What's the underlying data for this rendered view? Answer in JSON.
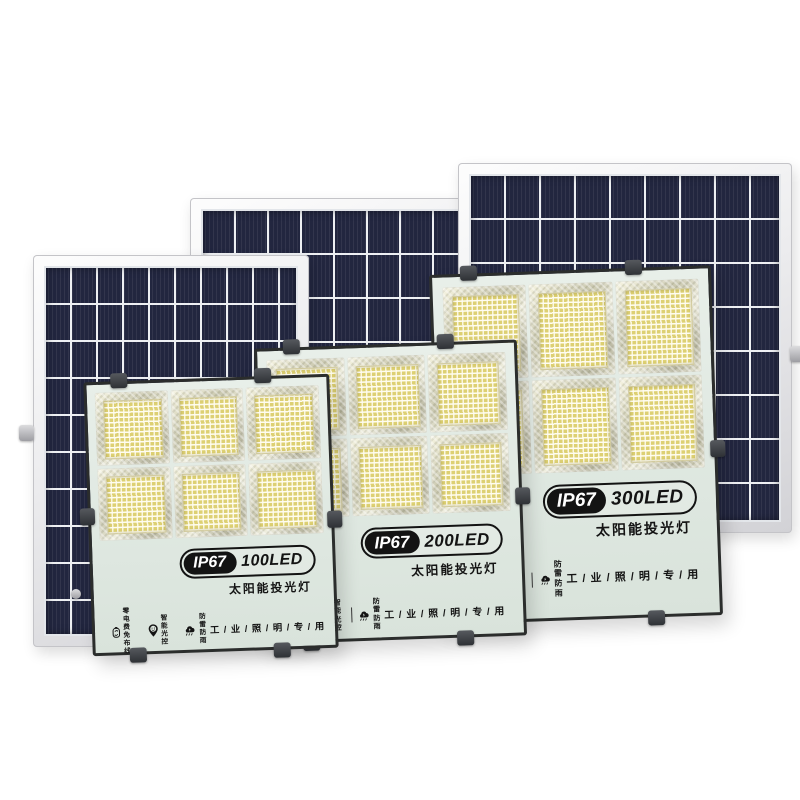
{
  "image_type": "product-photo",
  "subject": "solar-led-floodlights-with-solar-panels",
  "colors": {
    "background": "#ffffff",
    "solar_cell_navy": "#22263f",
    "panel_frame_silver": "#ececee",
    "light_face_mint": "#e1eae2",
    "light_frame_dark": "#2b2d2c",
    "badge_black": "#131313",
    "led_yellow": "#ddd073"
  },
  "panels": [
    {
      "name": "solar-panel-small-left"
    },
    {
      "name": "solar-panel-medium-back"
    },
    {
      "name": "solar-panel-large-right"
    }
  ],
  "lights": [
    {
      "ip_rating": "IP67",
      "led_count": "100LED",
      "subtitle": "太阳能投光灯",
      "usage": "工 / 业 / 照 / 明 / 专 / 用"
    },
    {
      "ip_rating": "IP67",
      "led_count": "200LED",
      "subtitle": "太阳能投光灯",
      "usage": "工 / 业 / 照 / 明 / 专 / 用"
    },
    {
      "ip_rating": "IP67",
      "led_count": "300LED",
      "subtitle": "太阳能投光灯",
      "usage": "工 / 业 / 照 / 明 / 专 / 用"
    }
  ],
  "features": [
    {
      "icon": "battery-recycle-icon",
      "line1": "零电费",
      "line2": "免布线"
    },
    {
      "icon": "smart-pin-icon",
      "line1": "智能",
      "line2": "光控"
    },
    {
      "icon": "storm-cloud-icon",
      "line1": "防雷",
      "line2": "防雨"
    }
  ]
}
